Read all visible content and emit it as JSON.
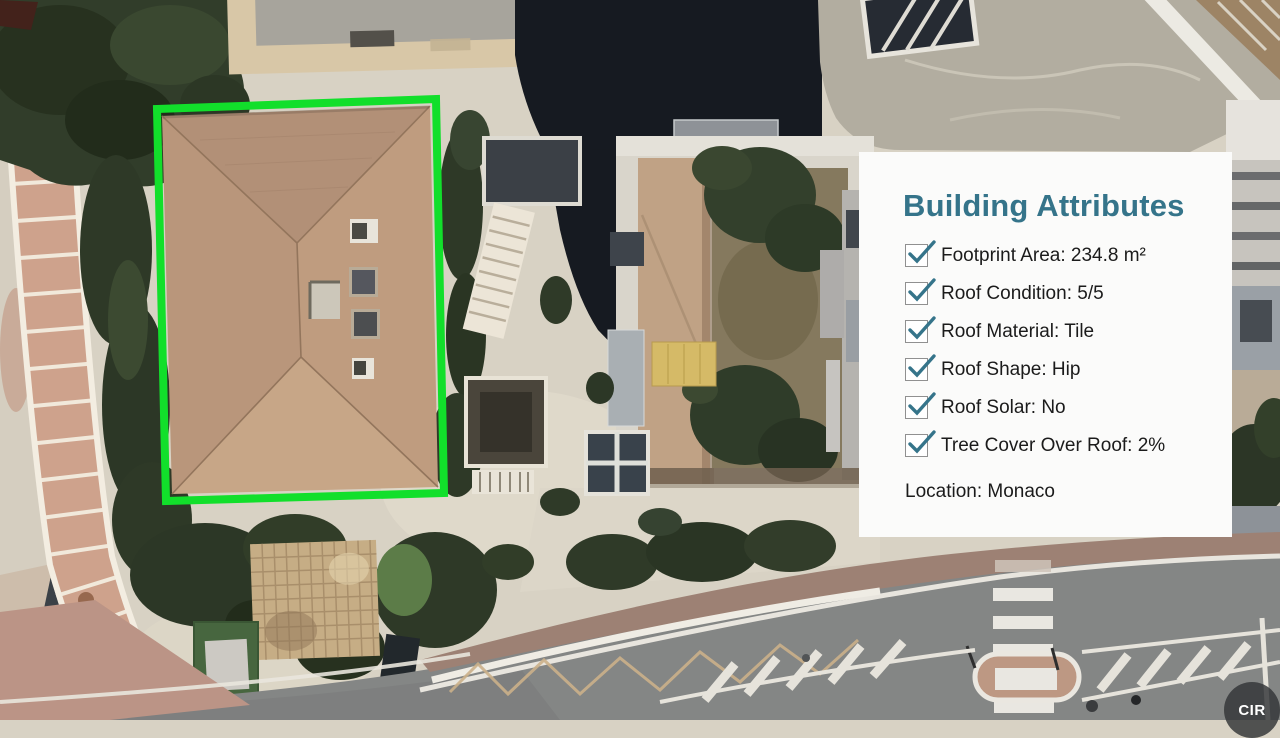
{
  "panel": {
    "title": "Building Attributes",
    "items": [
      {
        "label": "Footprint Area: 234.8 m²",
        "checked": true
      },
      {
        "label": "Roof Condition: 5/5",
        "checked": true
      },
      {
        "label": "Roof Material: Tile",
        "checked": true
      },
      {
        "label": "Roof Shape: Hip",
        "checked": true
      },
      {
        "label": "Roof Solar: No",
        "checked": true
      },
      {
        "label": "Tree Cover Over Roof: 2%",
        "checked": true
      }
    ],
    "location_label": "Location: Monaco"
  },
  "map": {
    "badge_label": "CIR"
  },
  "colors": {
    "highlight_green": "#12df2b",
    "accent_teal": "#35748a",
    "panel_bg": "#fbfbfa"
  }
}
